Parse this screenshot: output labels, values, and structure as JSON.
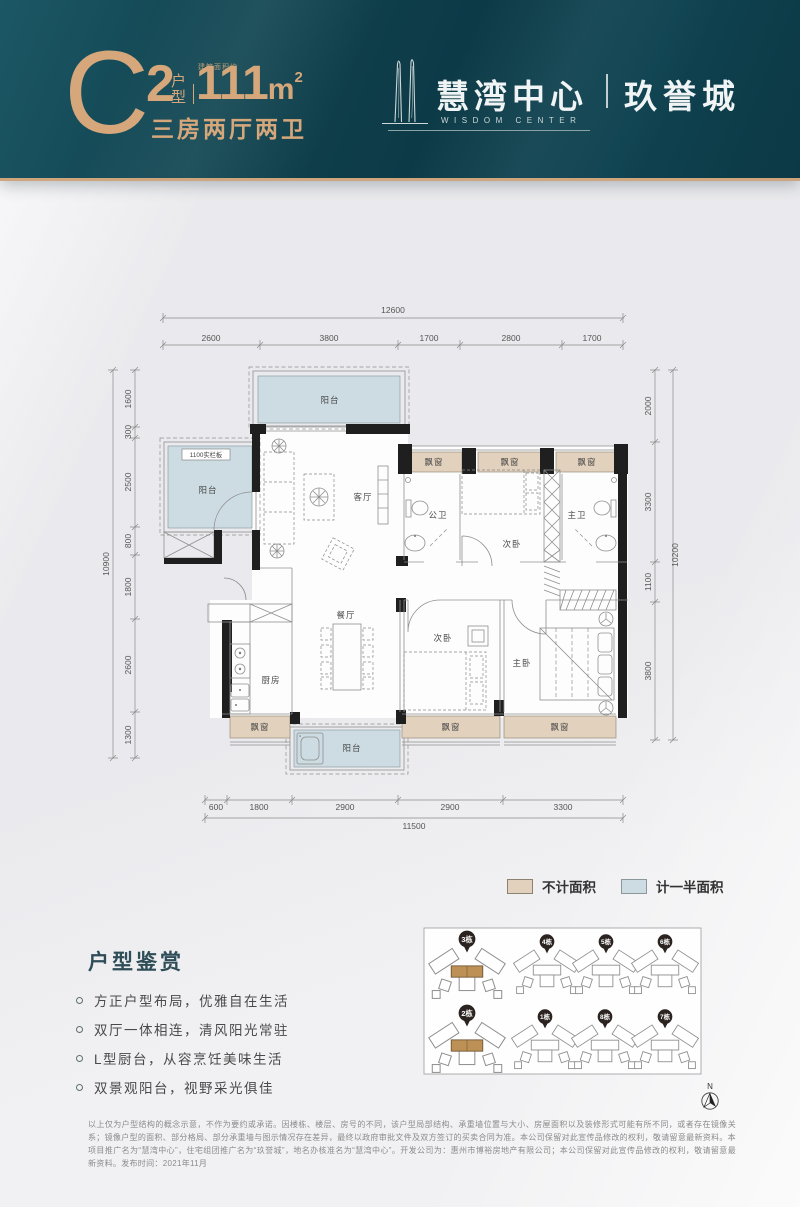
{
  "header": {
    "type_letter": "C",
    "unit_no": "2",
    "unit_label_v": "户型",
    "area_note": "建筑面积约",
    "area_value": "111",
    "area_unit": "m",
    "area_exp": "2",
    "layout_desc": "三房两厅两卫",
    "brand_cn": "慧湾中心",
    "brand_en": "WISDOM CENTER",
    "sub_brand": "玖誉城",
    "accent_color": "#d5a77b",
    "bg_color": "#0e3c4a"
  },
  "floorplan": {
    "rooms": {
      "balcony": "阳台",
      "living": "客厅",
      "dining": "餐厅",
      "kitchen": "厨房",
      "bedroom": "次卧",
      "master": "主卧",
      "bath_public": "公卫",
      "bath_master": "主卫",
      "bay_window": "飘窗",
      "rail_note": "1100实栏板"
    },
    "dims_top_total": "12600",
    "dims_top": [
      "2600",
      "3800",
      "1700",
      "2800",
      "1700"
    ],
    "dims_left_total": "10900",
    "dims_left": [
      "1600",
      "300",
      "2500",
      "800",
      "1800",
      "2600",
      "1300"
    ],
    "dims_right_total": "10200",
    "dims_right": [
      "2000",
      "3300",
      "1100",
      "3800"
    ],
    "dims_bottom_total": "11500",
    "dims_bottom": [
      "600",
      "1800",
      "2900",
      "2900",
      "3300"
    ]
  },
  "legend": {
    "no_area_label": "不计面积",
    "no_area_color": "#e2d1bc",
    "half_area_label": "计一半面积",
    "half_area_color": "#ccdce2"
  },
  "siteplan": {
    "buildings": [
      {
        "label": "3栋",
        "highlighted": true
      },
      {
        "label": "4栋",
        "highlighted": false
      },
      {
        "label": "5栋",
        "highlighted": false
      },
      {
        "label": "6栋",
        "highlighted": false
      },
      {
        "label": "2栋",
        "highlighted": true
      },
      {
        "label": "1栋",
        "highlighted": false
      },
      {
        "label": "8栋",
        "highlighted": false
      },
      {
        "label": "7栋",
        "highlighted": false
      }
    ]
  },
  "compass": {
    "label": "N"
  },
  "features": {
    "title": "户型鉴赏",
    "items": [
      "方正户型布局，优雅自在生活",
      "双厅一体相连，清风阳光常驻",
      "L型厨台，从容烹饪美味生活",
      "双景观阳台，视野采光俱佳"
    ]
  },
  "disclaimer": "以上仅为户型结构的概念示意，不作为要约或承诺。因楼栋、楼层、房号的不同，该户型局部结构、承重墙位置与大小、房屋面积以及装修形式可能有所不同，或者存在镜像关系；镜像户型的面积、部分格局、部分承重墙与图示情况存在差异，最终以政府审批文件及双方签订的买卖合同为准。本公司保留对此宣传品修改的权利，敬请留意最新资料。本项目推广名为“慧湾中心”，住宅组团推广名为“玖誉城”，地名办核准名为“慧湾中心”。开发公司为：惠州市博裕房地产有限公司；本公司保留对此宣传品修改的权利，敬请留意最新资料。发布时间：2021年11月"
}
